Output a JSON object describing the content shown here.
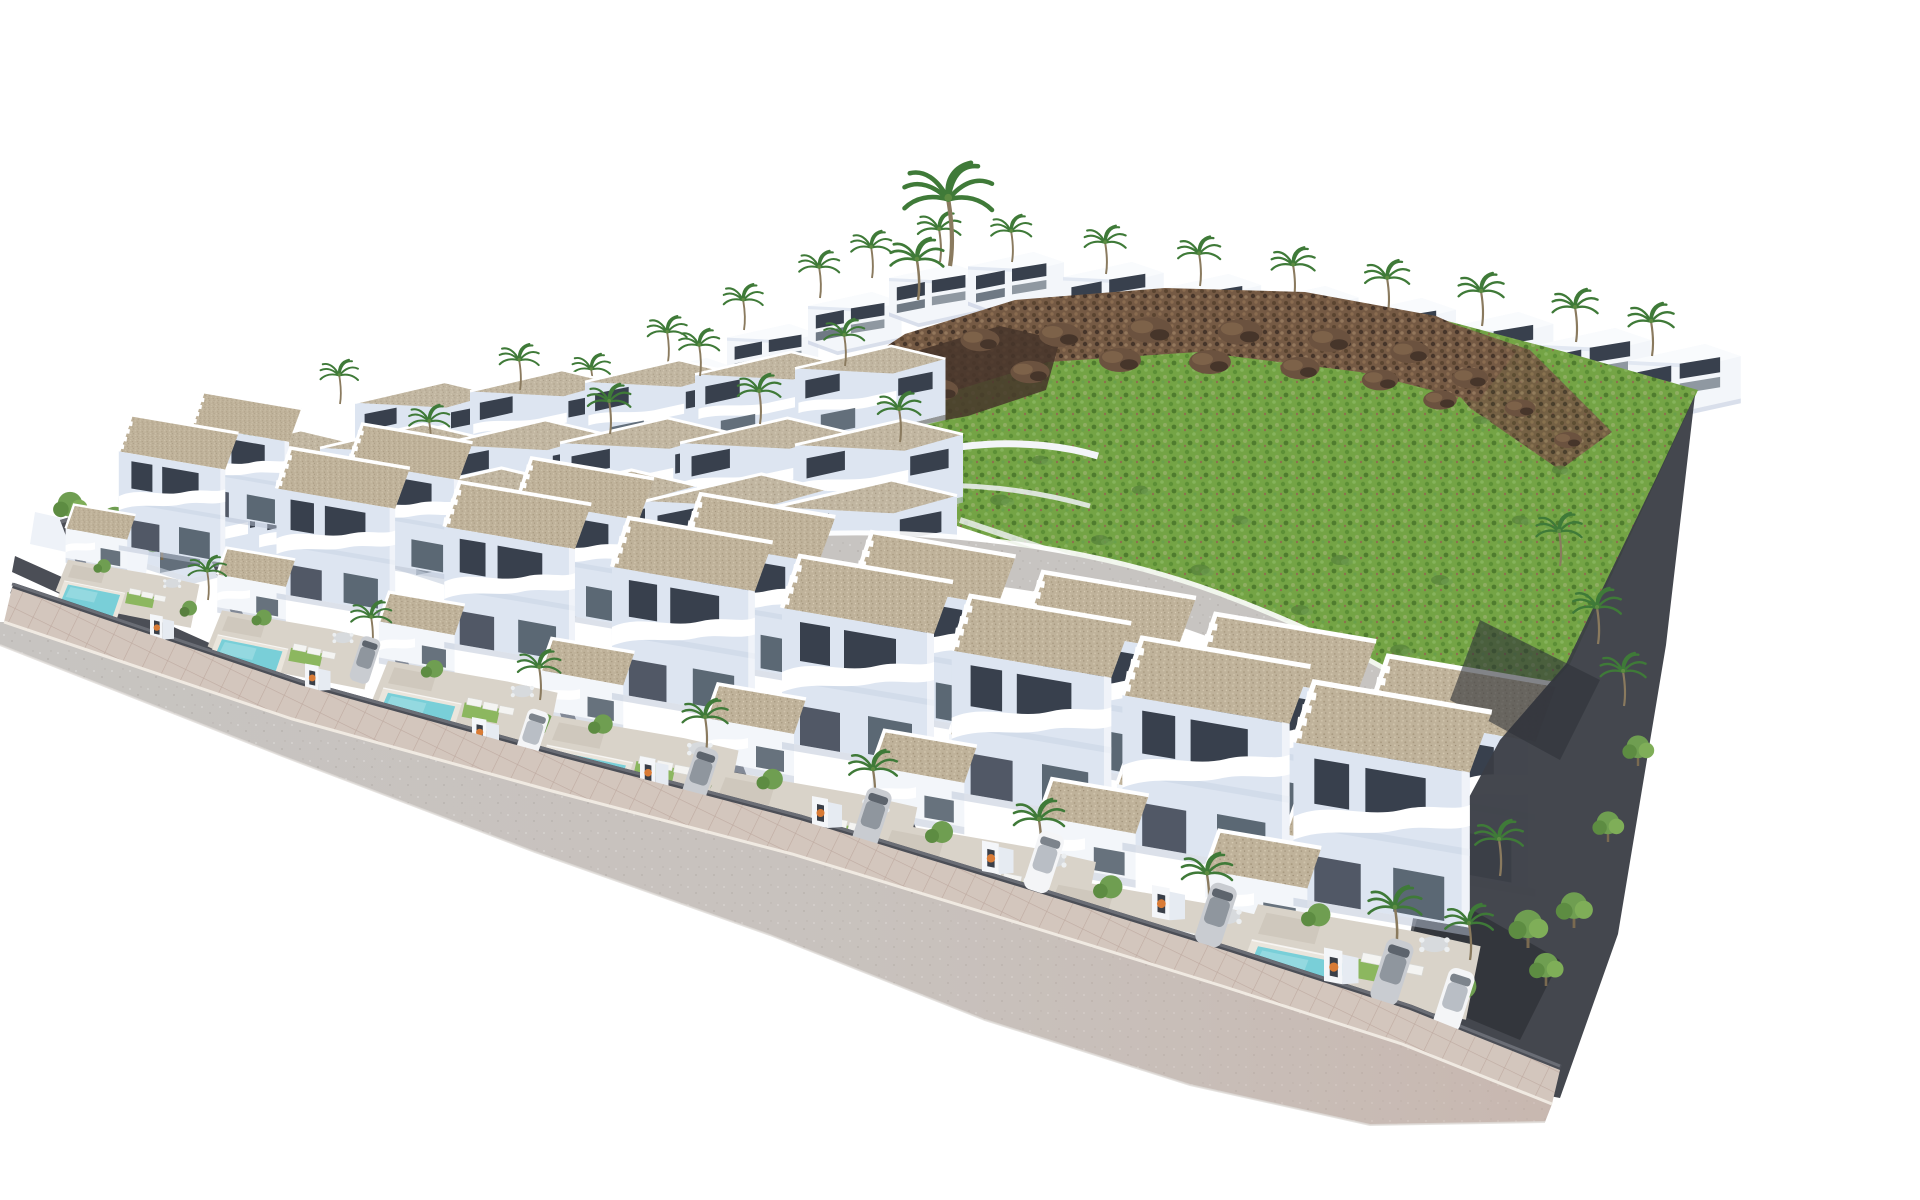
{
  "scene": {
    "description": "Aerial 3D architectural rendering of a coastal residential development: staggered rows of white modern two-storey villas with tan gravel flat roofs, curved white balconies, private turquoise pools, sun loungers, parked cars and palm trees; a green hillside with a brown rocky ridge occupies the upper right, and a grey perimeter road with pinkish pavement wraps the lower left edge of the walled site on a plain white background.",
    "inventory": {
      "front_row_villas": 8,
      "staggered_second_row_villas": 8,
      "middle_row_villas": 17,
      "background_row_villas": 19,
      "private_pools_visible": 8,
      "parked_cars": 8,
      "entrance_gates": 8,
      "palm_trees": 43,
      "round_trees_and_shrubs": 24
    },
    "layers": [
      {
        "target": "L-back-villas",
        "stamps": [
          {
            "ref": "villa-back",
            "pts": [
              [
                565,
                392,
                0.72
              ],
              [
                646,
                358,
                0.74
              ],
              [
                727,
                324,
                0.76
              ],
              [
                808,
                292,
                0.78
              ],
              [
                889,
                264,
                0.78
              ],
              [
                968,
                252,
                0.8
              ],
              [
                1063,
                262,
                0.84
              ],
              [
                1158,
                274,
                0.86
              ],
              [
                1253,
                286,
                0.88
              ],
              [
                1348,
                298,
                0.9
              ],
              [
                1443,
                312,
                0.92
              ],
              [
                1538,
                328,
                0.94
              ],
              [
                1628,
                344,
                0.94
              ],
              [
                1018,
                298,
                0.8
              ],
              [
                1116,
                310,
                0.82
              ],
              [
                1214,
                320,
                0.84
              ],
              [
                1312,
                332,
                0.86
              ],
              [
                1410,
                346,
                0.88
              ],
              [
                1508,
                362,
                0.9
              ]
            ]
          }
        ]
      },
      {
        "target": "L-skyline-palms",
        "stamps": [
          {
            "ref": "palm",
            "pts": [
              [
                592,
                398,
                0.75
              ],
              [
                668,
                362,
                0.78
              ],
              [
                744,
                330,
                0.78
              ],
              [
                820,
                298,
                0.8
              ],
              [
                872,
                278,
                0.8
              ],
              [
                940,
                262,
                0.85
              ],
              [
                1012,
                262,
                0.8
              ],
              [
                1106,
                274,
                0.82
              ],
              [
                1200,
                286,
                0.84
              ],
              [
                1294,
                298,
                0.86
              ],
              [
                1388,
                312,
                0.88
              ],
              [
                1482,
                326,
                0.9
              ],
              [
                1576,
                342,
                0.9
              ],
              [
                1652,
                356,
                0.9
              ],
              [
                950,
                266,
                1.75
              ],
              [
                918,
                300,
                1.05
              ]
            ]
          }
        ]
      },
      {
        "target": "L-hill-details",
        "stamps": [
          {
            "ref": "rock",
            "pts": [
              [
                900,
                360,
                1.2
              ],
              [
                980,
                340,
                1.4
              ],
              [
                1060,
                335,
                1.5
              ],
              [
                1150,
                330,
                1.6
              ],
              [
                1240,
                332,
                1.6
              ],
              [
                1330,
                340,
                1.5
              ],
              [
                1410,
                352,
                1.4
              ],
              [
                1470,
                378,
                1.3
              ],
              [
                1520,
                408,
                1.1
              ],
              [
                940,
                390,
                1.3
              ],
              [
                1030,
                372,
                1.4
              ],
              [
                1120,
                360,
                1.5
              ],
              [
                1210,
                362,
                1.5
              ],
              [
                1300,
                368,
                1.4
              ],
              [
                1380,
                380,
                1.3
              ],
              [
                1440,
                400,
                1.2
              ],
              [
                890,
                410,
                1.1
              ],
              [
                1568,
                440,
                1.0
              ]
            ]
          },
          {
            "ref": "scrub",
            "pts": [
              [
                900,
                470,
                1.0
              ],
              [
                1000,
                500,
                1.1
              ],
              [
                1100,
                540,
                1.0
              ],
              [
                1200,
                570,
                1.1
              ],
              [
                1300,
                610,
                1.0
              ],
              [
                1400,
                650,
                1.1
              ],
              [
                1480,
                680,
                1.0
              ],
              [
                1340,
                560,
                1.0
              ],
              [
                1240,
                520,
                0.9
              ],
              [
                1140,
                490,
                0.9
              ],
              [
                1040,
                460,
                0.9
              ],
              [
                1440,
                580,
                1.0
              ],
              [
                1520,
                520,
                0.9
              ],
              [
                1560,
                470,
                0.9
              ],
              [
                1480,
                420,
                0.8
              ]
            ]
          }
        ]
      },
      {
        "target": "L-mid-villas",
        "stamps": [
          {
            "ref": "villa-mid",
            "pts": [
              [
                355,
                382,
                0.8
              ],
              [
                470,
                370,
                0.82
              ],
              [
                585,
                360,
                0.84
              ],
              [
                695,
                352,
                0.86
              ],
              [
                795,
                346,
                0.86
              ],
              [
                200,
                430,
                0.9
              ],
              [
                320,
                424,
                0.92
              ],
              [
                440,
                420,
                0.94
              ],
              [
                560,
                418,
                0.96
              ],
              [
                680,
                418,
                0.96
              ],
              [
                795,
                420,
                0.96
              ],
              [
                130,
                470,
                1.0
              ],
              [
                255,
                468,
                1.02
              ],
              [
                385,
                468,
                1.04
              ],
              [
                515,
                470,
                1.04
              ],
              [
                645,
                474,
                1.04
              ],
              [
                775,
                480,
                1.04
              ]
            ]
          },
          {
            "ref": "palm",
            "pts": [
              [
                250,
                472,
                0.8
              ],
              [
                430,
                452,
                0.8
              ],
              [
                610,
                434,
                0.85
              ],
              [
                760,
                424,
                0.85
              ],
              [
                900,
                442,
                0.85
              ],
              [
                340,
                404,
                0.75
              ],
              [
                520,
                390,
                0.78
              ],
              [
                700,
                376,
                0.8
              ],
              [
                845,
                366,
                0.8
              ]
            ]
          }
        ]
      },
      {
        "target": "L-stagger",
        "stamps": [
          {
            "ref": "villa-front",
            "pts": [
              [
                170,
                392,
                0.64
              ],
              [
                325,
                424,
                0.72
              ],
              [
                490,
                458,
                0.8
              ],
              [
                655,
                494,
                0.88
              ],
              [
                823,
                532,
                0.94
              ],
              [
                991,
                572,
                1.0
              ],
              [
                1161,
                614,
                1.05
              ],
              [
                1331,
                656,
                1.1
              ]
            ]
          }
        ]
      },
      {
        "target": "L-front",
        "stamps": [
          {
            "ref": "tree",
            "pts": [
              [
                70,
                525,
                1.3
              ],
              [
                115,
                545,
                1.5
              ],
              [
                162,
                560,
                1.3
              ]
            ]
          },
          {
            "ref": "plotwall",
            "pts": [
              [
                60,
                520,
                0.7
              ],
              [
                212,
                562,
                0.78
              ],
              [
                376,
                610,
                0.86
              ],
              [
                540,
                660,
                0.94
              ],
              [
                706,
                706,
                1.0
              ],
              [
                872,
                752,
                1.05
              ],
              [
                1038,
                800,
                1.1
              ],
              [
                1204,
                848,
                1.16
              ]
            ]
          },
          {
            "ref": "villa-front",
            "pts": [
              [
                95,
                415,
                0.7
              ],
              [
                250,
                448,
                0.78
              ],
              [
                415,
                482,
                0.86
              ],
              [
                580,
                518,
                0.94
              ],
              [
                748,
                556,
                1.0
              ],
              [
                916,
                596,
                1.05
              ],
              [
                1085,
                638,
                1.1
              ],
              [
                1254,
                682,
                1.16
              ]
            ]
          },
          {
            "ref": "yard",
            "pts": [
              [
                68,
                556,
                0.62
              ],
              [
                222,
                606,
                0.72
              ],
              [
                388,
                656,
                0.8
              ],
              [
                552,
                710,
                0.88
              ],
              [
                718,
                764,
                0.94
              ],
              [
                884,
                816,
                1.0
              ],
              [
                1050,
                870,
                1.05
              ],
              [
                1258,
                898,
                1.05
              ]
            ]
          },
          {
            "ref": "palm",
            "pts": [
              [
                208,
                600,
                0.75
              ],
              [
                372,
                648,
                0.8
              ],
              [
                540,
                700,
                0.85
              ],
              [
                706,
                752,
                0.9
              ],
              [
                874,
                806,
                0.95
              ],
              [
                1040,
                858,
                1.0
              ],
              [
                1208,
                912,
                1.0
              ],
              [
                1396,
                948,
                1.05
              ],
              [
                1560,
                566,
                0.9
              ],
              [
                1598,
                644,
                0.95
              ],
              [
                1624,
                706,
                0.9
              ],
              [
                1500,
                876,
                0.95
              ],
              [
                1470,
                960,
                0.95
              ]
            ]
          },
          {
            "ref": "tree",
            "pts": [
              [
                1528,
                948,
                1.5
              ],
              [
                1574,
                928,
                1.4
              ],
              [
                1546,
                986,
                1.3
              ],
              [
                1608,
                842,
                1.2
              ],
              [
                1638,
                766,
                1.2
              ]
            ]
          }
        ]
      },
      {
        "target": "L-curbside",
        "stamps": [
          {
            "ref": "gate",
            "pts": [
              [
                150,
                638,
                0.8
              ],
              [
                305,
                689,
                0.85
              ],
              [
                472,
                744,
                0.9
              ],
              [
                640,
                785,
                0.95
              ],
              [
                812,
                826,
                1.0
              ],
              [
                982,
                872,
                1.05
              ],
              [
                1152,
                918,
                1.1
              ],
              [
                1324,
                982,
                1.15
              ]
            ]
          },
          {
            "ref": "car-silver",
            "pts": [
              [
                365,
                660,
                0.78,
                18
              ],
              [
                700,
                775,
                0.94,
                18
              ],
              [
                872,
                818,
                1.0,
                18
              ],
              [
                1216,
                915,
                1.06,
                18
              ],
              [
                1392,
                972,
                1.1,
                18
              ]
            ]
          },
          {
            "ref": "car-white",
            "pts": [
              [
                532,
                735,
                0.86,
                18
              ],
              [
                1044,
                862,
                1.02,
                18
              ],
              [
                1454,
                1000,
                1.05,
                18
              ]
            ]
          }
        ]
      }
    ]
  },
  "palette": {
    "bg": "#ffffff",
    "villaWhite": "#f3f6fa",
    "villaLight": "#dde5f1",
    "villaShade": "#c3cfe2",
    "windowDark": "#38404d",
    "windowGlass": "#4d5a66",
    "roofGravel": "#bfb29a",
    "wallDark": "#4b4e56",
    "wallDarker": "#3a3d44",
    "roadGray": "#c7c4c1",
    "sidewalkPink": "#d3c6bd",
    "curbLight": "#f0eae2",
    "poolBlue": "#79cfd8",
    "poolLight": "#ace2e8",
    "grassGreen": "#74a445",
    "scrubGreen": "#55803a",
    "rockBrown": "#755a44",
    "rockDark": "#46352a",
    "earthBrown": "#93775c",
    "palmGreen": "#3f7a38",
    "treeGreen": "#6f9e51",
    "carSilver": "#c9ccd1",
    "carWhite": "#f4f5f7",
    "flowerOrange": "#d97b35",
    "patioTan": "#d9d3c9"
  }
}
